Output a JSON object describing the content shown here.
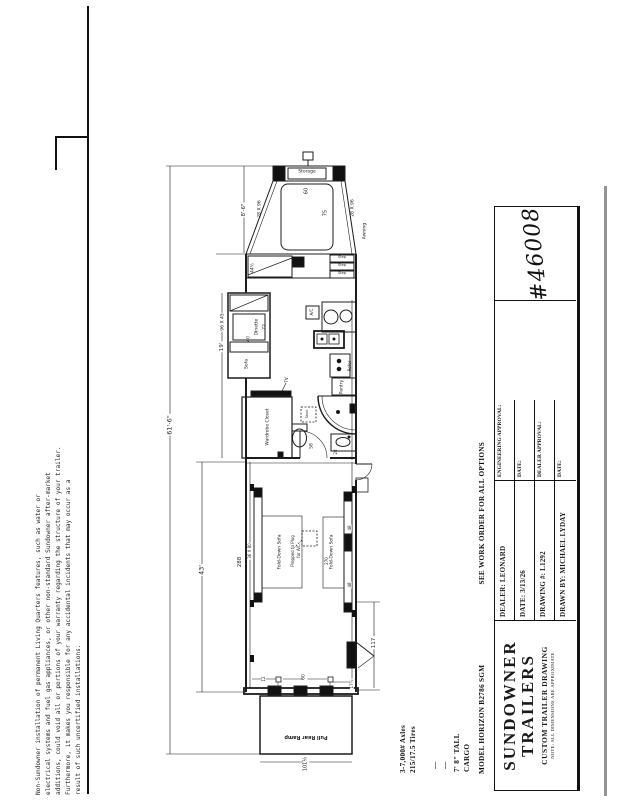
{
  "disclaimer": {
    "lines": [
      "Non-Sundowner installation of permanent Living Quarters features, such as water or",
      "electrical systems and fuel gas appliances, or other non-standard Sundowner after-market",
      "additions, could void all or portions of your warranty regarding the structure of your trailer.",
      "Furthermore, it makes you responsible for any accidental incidents that may occur as a",
      "result of such uncertified installations."
    ]
  },
  "notes_column": {
    "axles_line1": "3-7,000# Axles",
    "axles_line2": "215/17.5 Tires",
    "dash1": "—",
    "dash2": "—",
    "height_line1": "7' 8\" TALL",
    "height_line2": "CARGO",
    "model_line": "MODEL HORIZON B2786 SGM",
    "options_line": "SEE WORK ORDER FOR ALL OPTIONS"
  },
  "title_block": {
    "brand_line1": "SUNDOWNER",
    "brand_line2": "TRAILERS",
    "subtitle": "CUSTOM TRAILER DRAWING",
    "note": "NOTE: ALL DIMENSIONS ARE APPROXIMATE",
    "dealer": "DEALER: LEONARD",
    "date": "DATE: 3/13/26",
    "drawing_no": "DRAWING #: L1292",
    "drawn_by": "DRAWN BY: MICHAEL LYDAY",
    "eng_approval": "ENGINEERING APPROVAL:",
    "eng_date": "DATE:",
    "dealer_approval": "DEALER APPROVAL:",
    "dealer_date": "DATE:",
    "sheet_number": "#46008"
  },
  "floorplan": {
    "labels": {
      "storage": "Storage",
      "step": "Step",
      "dinette": "Dinette",
      "sofa": "Sofa",
      "ac_unit": "A/C",
      "refer": "Refer",
      "pantry": "Pantry",
      "tv": "TV",
      "wardrobe": "Wardrobe Closet",
      "stool": "Stool",
      "awning": "Awning",
      "fold_down_sofa_left": "Fold-Down Sofa",
      "fold_down_sofa_right": "Fold-Down Sofa",
      "prepped_line1": "Prepped to Plug",
      "prepped_line2": "for A/C",
      "pull_rear_ramp": "Pull Rear Ramp"
    },
    "dims": {
      "overall_length": "61'-6\"",
      "gooseneck_length": "8'-6\"",
      "lq_length": "19'",
      "cargo_length": "43'",
      "cargo_interior": "288",
      "bed_width": "60",
      "bed_length": "75",
      "bed_side_left": "28 X 96",
      "bed_side_right": "28 X 96",
      "step_width": "44½",
      "dinette_size": "96 X 45",
      "dinette_length": "72",
      "dinette_width": "40",
      "door_width": "58",
      "dim_28": "28",
      "sofa_size": "36 X 80",
      "dim_48a": "48",
      "dim_48b": "48",
      "dim_270": "270",
      "rear_section": "117",
      "dim_12": "12",
      "rear_door_width": "60",
      "dim_17half": "17½",
      "ramp_width": "101½"
    }
  }
}
